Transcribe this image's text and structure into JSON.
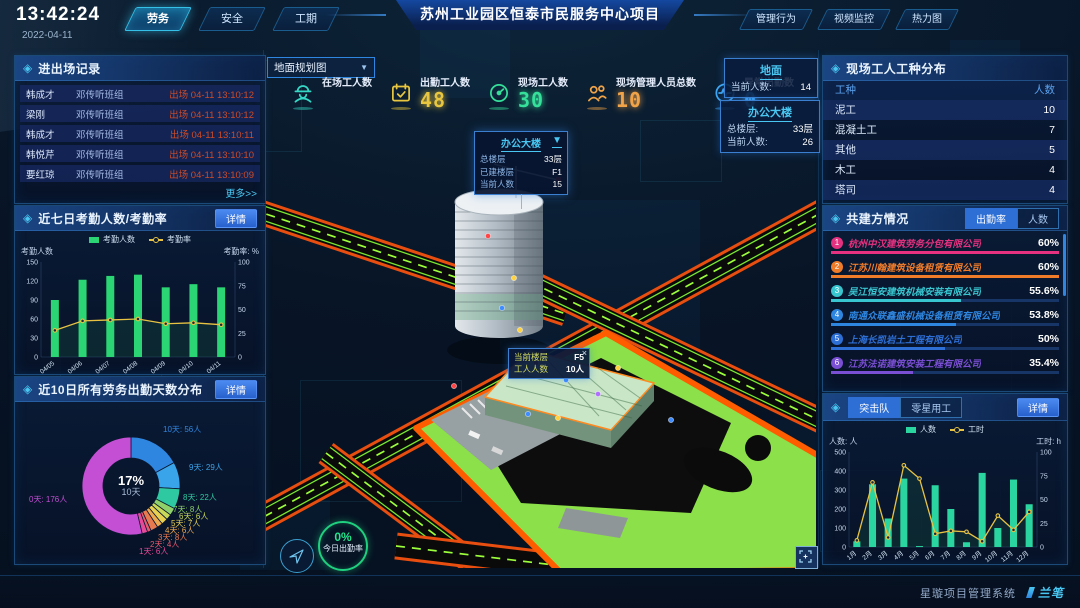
{
  "header": {
    "time": "13:42:24",
    "date": "2022-04-11",
    "left_tabs": [
      {
        "label": "劳务",
        "active": true
      },
      {
        "label": "安全",
        "active": false
      },
      {
        "label": "工期",
        "active": false
      }
    ],
    "title": "苏州工业园区恒泰市民服务中心项目",
    "right_tabs": [
      {
        "label": "管理行为",
        "active": false
      },
      {
        "label": "视频监控",
        "active": false
      },
      {
        "label": "热力图",
        "active": false
      }
    ]
  },
  "records_panel": {
    "title": "进出场记录",
    "more": "更多>>",
    "rows": [
      {
        "name": "韩成才",
        "group": "邓传听班组",
        "event": "出场 04-11 13:10:12"
      },
      {
        "name": "梁刚",
        "group": "邓传听班组",
        "event": "出场 04-11 13:10:12"
      },
      {
        "name": "韩成才",
        "group": "邓传听班组",
        "event": "出场 04-11 13:10:11"
      },
      {
        "name": "韩悦芹",
        "group": "邓传听班组",
        "event": "出场 04-11 13:10:10"
      },
      {
        "name": "要红琼",
        "group": "邓传听班组",
        "event": "出场 04-11 13:10:09"
      }
    ]
  },
  "attendance_panel": {
    "title": "近七日考勤人数/考勤率",
    "detail": "详情"
  },
  "distribution_panel": {
    "title": "近10日所有劳务出勤天数分布",
    "detail": "详情"
  },
  "map": {
    "view_select": "地面规划图",
    "stats": [
      {
        "icon": "worker-icon",
        "label": "在场工人数",
        "value": "",
        "color": "#35d8c5"
      },
      {
        "icon": "calendar-icon",
        "label": "出勤工人数",
        "value": "48",
        "color": "#e8c63f"
      },
      {
        "icon": "gauge-icon",
        "label": "现场工人数",
        "value": "30",
        "color": "#35e09a"
      },
      {
        "icon": "people-icon",
        "label": "现场管理人员总数",
        "value": "10",
        "color": "#f0a348"
      },
      {
        "icon": "pulse-icon",
        "label": "异常出勤数",
        "value": "0",
        "color": "#3fa8f5"
      }
    ],
    "building_popup": {
      "title": "办公大楼",
      "rows": [
        {
          "label": "总楼层",
          "value": "33层"
        },
        {
          "label": "已建楼层",
          "value": "F1"
        },
        {
          "label": "当前人数",
          "value": "15"
        }
      ]
    },
    "floor_tooltip": {
      "close": "×",
      "rows": [
        {
          "label": "当前楼层",
          "value": "F5"
        },
        {
          "label": "工人人数",
          "value": "10人"
        }
      ]
    },
    "overlay_cards": [
      {
        "id": "ground",
        "title": "地面",
        "rows": [
          {
            "label": "当前人数:",
            "value": "14"
          }
        ]
      },
      {
        "id": "tower",
        "title": "办公大楼",
        "rows": [
          {
            "label": "总楼层:",
            "value": "33层"
          },
          {
            "label": "当前人数:",
            "value": "26"
          }
        ]
      }
    ],
    "gauge": {
      "value": "0%",
      "label": "今日出勤率"
    }
  },
  "workers_panel": {
    "title": "现场工人工种分布",
    "columns": [
      "工种",
      "人数"
    ],
    "rows": [
      {
        "type": "泥工",
        "count": "10"
      },
      {
        "type": "混凝土工",
        "count": "7"
      },
      {
        "type": "其他",
        "count": "5"
      },
      {
        "type": "木工",
        "count": "4"
      },
      {
        "type": "塔司",
        "count": "4"
      }
    ]
  },
  "partners_panel": {
    "title": "共建方情况",
    "tabs": [
      {
        "label": "出勤率",
        "active": true
      },
      {
        "label": "人数",
        "active": false
      }
    ],
    "items": [
      {
        "rank": "1",
        "name": "杭州中汉建筑劳务分包有限公司",
        "value": "60%",
        "bar_pct": 100,
        "color": "#e5317f"
      },
      {
        "rank": "2",
        "name": "江苏川翰建筑设备租赁有限公司",
        "value": "60%",
        "bar_pct": 100,
        "color": "#f07c2a"
      },
      {
        "rank": "3",
        "name": "吴江恒安建筑机械安装有限公司",
        "value": "55.6%",
        "bar_pct": 57,
        "color": "#38c5d0"
      },
      {
        "rank": "4",
        "name": "南通众联鑫盛机械设备租赁有限公司",
        "value": "53.8%",
        "bar_pct": 55,
        "color": "#2f86e0"
      },
      {
        "rank": "5",
        "name": "上海长凯岩土工程有限公司",
        "value": "50%",
        "bar_pct": 50,
        "color": "#2e6fd6"
      },
      {
        "rank": "6",
        "name": "江苏法诺建筑安装工程有限公司",
        "value": "35.4%",
        "bar_pct": 36,
        "color": "#7a4fd4"
      }
    ]
  },
  "teams_panel": {
    "tabs": [
      {
        "label": "突击队",
        "active": true
      },
      {
        "label": "零星用工",
        "active": false
      }
    ],
    "detail": "详情"
  },
  "footer": {
    "system_name": "星璇项目管理系统",
    "logo": "兰笔"
  },
  "chart_data": [
    {
      "id": "attendance",
      "type": "bar+line",
      "title": "近七日考勤人数/考勤率",
      "categories": [
        "04/05",
        "04/06",
        "04/07",
        "04/08",
        "04/09",
        "04/10",
        "04/11"
      ],
      "series": [
        {
          "name": "考勤人数",
          "type": "bar",
          "axis": "left",
          "color": "#2bd573",
          "values": [
            90,
            122,
            128,
            130,
            110,
            115,
            110
          ]
        },
        {
          "name": "考勤率",
          "type": "line",
          "axis": "right",
          "color": "#e8c343",
          "values": [
            28,
            38,
            39,
            40,
            35,
            36,
            34
          ]
        }
      ],
      "ylabel_left": "考勤人数",
      "ylabel_right": "考勤率: %",
      "ylim_left": [
        0,
        150
      ],
      "yticks_left": [
        0,
        30,
        60,
        90,
        120,
        150
      ],
      "ylim_right": [
        0,
        100
      ],
      "yticks_right": [
        0,
        25,
        50,
        75,
        100
      ],
      "legend_position": "top",
      "grid": false
    },
    {
      "id": "distribution",
      "type": "donut",
      "title": "近10日所有劳务出勤天数分布",
      "center_value": "17%",
      "center_label": "10天",
      "slices": [
        {
          "label": "10天",
          "value": 56,
          "text": "10天: 56人",
          "color": "#2f86e0"
        },
        {
          "label": "9天",
          "value": 29,
          "text": "9天: 29人",
          "color": "#3aa4ea"
        },
        {
          "label": "8天",
          "value": 22,
          "text": "8天: 22人",
          "color": "#2ec9a0"
        },
        {
          "label": "7天",
          "value": 8,
          "text": "7天: 8人",
          "color": "#8fd06a"
        },
        {
          "label": "6天",
          "value": 6,
          "text": "6天: 6人",
          "color": "#c8d858"
        },
        {
          "label": "5天",
          "value": 7,
          "text": "5天: 7人",
          "color": "#e8d050"
        },
        {
          "label": "4天",
          "value": 6,
          "text": "4天: 6人",
          "color": "#eda94e"
        },
        {
          "label": "3天",
          "value": 8,
          "text": "3天: 8人",
          "color": "#e87a50"
        },
        {
          "label": "2天",
          "value": 4,
          "text": "2天: 4人",
          "color": "#e85a70"
        },
        {
          "label": "1天",
          "value": 6,
          "text": "1天: 6人",
          "color": "#e84a9a"
        },
        {
          "label": "0天",
          "value": 176,
          "text": "0天: 176人",
          "color": "#c44fd4"
        }
      ]
    },
    {
      "id": "teams",
      "type": "bar+line",
      "title": "突击队",
      "categories": [
        "1月",
        "2月",
        "3月",
        "4月",
        "5月",
        "6月",
        "7月",
        "8月",
        "9月",
        "10月",
        "11月",
        "12月"
      ],
      "series": [
        {
          "name": "人数",
          "type": "bar",
          "axis": "left",
          "color": "#2bd5a0",
          "values": [
            30,
            330,
            150,
            360,
            5,
            325,
            200,
            25,
            390,
            100,
            355,
            225
          ]
        },
        {
          "name": "工时",
          "type": "line",
          "axis": "right",
          "color": "#e8c343",
          "values": [
            7,
            68,
            10,
            86,
            72,
            14,
            17,
            16,
            6,
            33,
            18,
            37
          ]
        }
      ],
      "ylabel_left": "人数: 人",
      "ylabel_right": "工时: h",
      "ylim_left": [
        0,
        500
      ],
      "yticks_left": [
        0,
        100,
        200,
        300,
        400,
        500
      ],
      "ylim_right": [
        0,
        100
      ],
      "yticks_right": [
        0,
        25,
        50,
        75,
        100
      ],
      "legend_position": "top",
      "grid": false
    }
  ]
}
